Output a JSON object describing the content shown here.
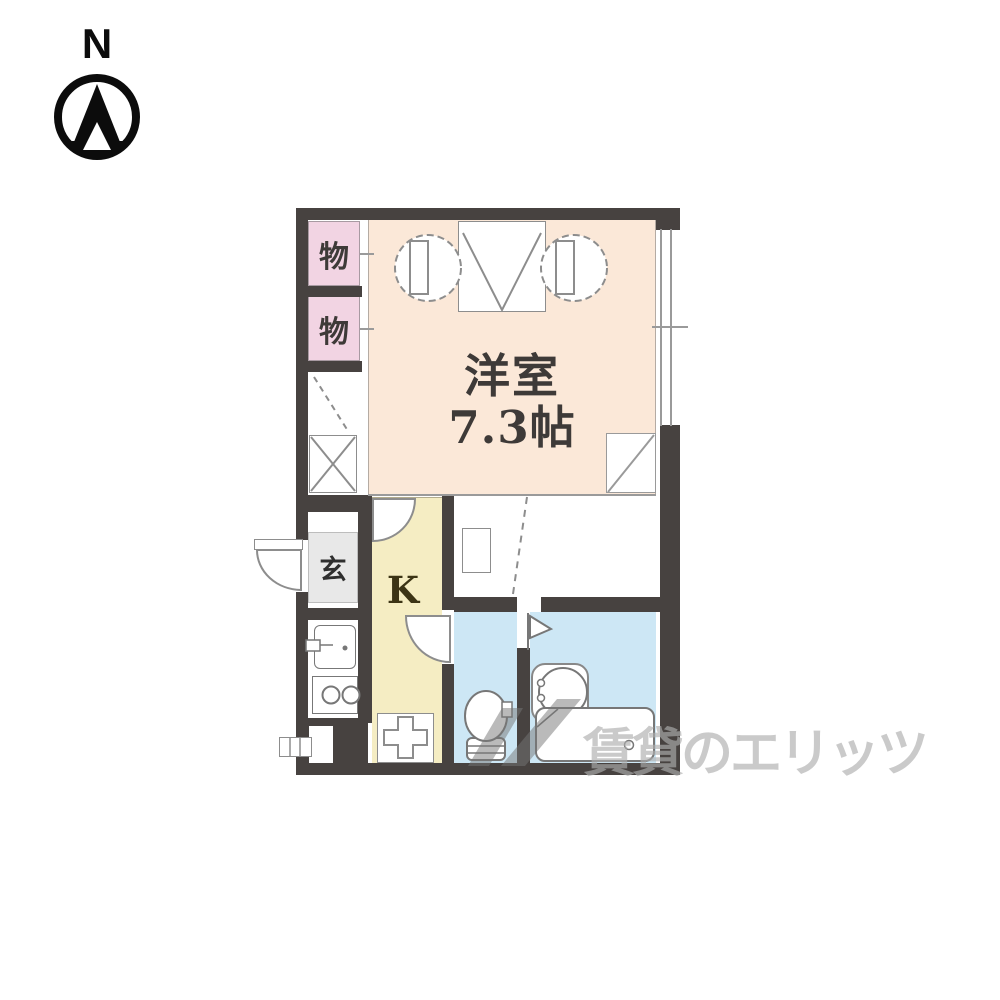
{
  "compass": {
    "north_label": "N"
  },
  "floorplan": {
    "wall_color": "#474240",
    "rooms": {
      "storage_1": {
        "label": "物",
        "color": "#f2d4e3"
      },
      "storage_2": {
        "label": "物",
        "color": "#f2d4e3"
      },
      "western_room": {
        "name_label": "洋室",
        "size_label": "7.3帖",
        "color": "#fbe8d8"
      },
      "entrance": {
        "label": "玄",
        "color": "#e8e8e8"
      },
      "kitchen": {
        "label": "K",
        "color": "#f5edc3"
      },
      "toilet": {
        "color": "#cde7f5"
      },
      "bathroom": {
        "color": "#cde7f5"
      }
    },
    "fixtures": [
      "closet",
      "entry-door",
      "wash-basin",
      "stove",
      "kitchen-sink",
      "toilet",
      "bathroom-basin",
      "bathtub",
      "window"
    ]
  },
  "watermark": {
    "text": "賃貸のエリッツ",
    "color": "#c0c0c0"
  }
}
